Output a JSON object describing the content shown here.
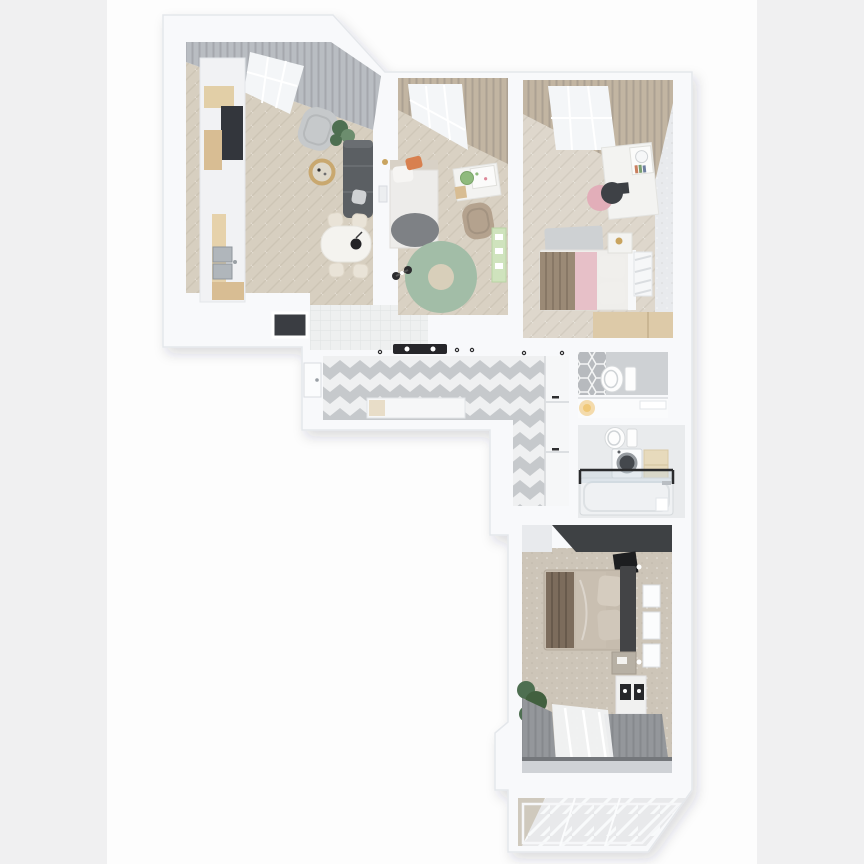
{
  "scene": {
    "type": "3d-floor-plan-render",
    "view": "top-down axonometric render of a two-bedroom-plus apartment",
    "background": "white canvas with light gray letterbox bars on left and right",
    "rooms": [
      {
        "id": "living-kitchen",
        "label": "kitchen-living-room",
        "features": [
          "kitchen run along left wall",
          "dark appliance column",
          "double steel sink",
          "gray armchair",
          "charcoal sofa",
          "round coffee table",
          "oval dining table with four cream chairs",
          "black pendant lamp",
          "gray curtains on angled window wall",
          "white tiled kitchen zone",
          "wall niche"
        ]
      },
      {
        "id": "bedroom-1",
        "label": "kids-bedroom",
        "features": [
          "single bed with orange pillow and gray throw",
          "green round rug",
          "white desk with pinboard",
          "green chair",
          "tan armchair",
          "green play shelf",
          "toy tricycle",
          "tan curtains with skylight window"
        ]
      },
      {
        "id": "bedroom-2",
        "label": "bedroom-with-pink-accents",
        "features": [
          "double bed with brown and pink blankets",
          "white desk with hutch and round mirror",
          "pink chair with dark jacket",
          "gray rug",
          "nightstand with gold lamp",
          "louvered wardrobe",
          "wood built-in block",
          "tan curtains with skylight window"
        ]
      },
      {
        "id": "hallway",
        "label": "hallway",
        "features": [
          "gray and white chevron tile floor",
          "white console",
          "beige tray",
          "built-in closets with black handles",
          "entry door",
          "black linear ceiling light",
          "spotlights"
        ]
      },
      {
        "id": "wc",
        "label": "wc",
        "features": [
          "toilet",
          "gray hex accent tiles"
        ]
      },
      {
        "id": "niche",
        "label": "hall-niche",
        "features": [
          "white shelf",
          "warm table lamp"
        ]
      },
      {
        "id": "bathroom",
        "label": "bathroom",
        "features": [
          "toilet",
          "washing machine with round door",
          "beige cabinet",
          "bathtub with black-trimmed glass screen"
        ]
      },
      {
        "id": "bedroom-3",
        "label": "master-bedroom",
        "features": [
          "dark wardrobe wall",
          "wall TV",
          "double bed with brown pleated throw",
          "white wall moldings",
          "sconces",
          "dark-top nightstand",
          "white dresser with dark trays",
          "plant",
          "gray drapes with white sheer",
          "window wall"
        ]
      },
      {
        "id": "balcony",
        "label": "glazed-balcony",
        "features": [
          "diagonal plank floor",
          "angled outer corner",
          "glazing frames"
        ]
      }
    ]
  },
  "colors": {
    "pagebg": "#fdfdfd",
    "sidebar": "#f0f0f1",
    "wall": "#f8f9fb",
    "wall_stroke": "#e4e7eb",
    "wall_face": "#e8eaed",
    "floor_living": "#d7cfc0",
    "floor_bed1": "#d9d1c3",
    "floor_bed2": "#ded7cc",
    "floor_bed3": "#cdc5b8",
    "tile_white": "#eef0f0",
    "hall_white": "#eff0f1",
    "hall_gray": "#c6c9cc",
    "wc_floor": "#ced1d4",
    "hex_gray": "#b7babe",
    "bath_floor": "#e9ebed",
    "curtain_gray": "#b9bdc2",
    "curtain_tan": "#c2b5a2",
    "curtain_dark": "#94979b",
    "sheer": "#f3f4f5",
    "window_glass": "#f4f6f8",
    "sofa_dark": "#5b5f63",
    "chair_gray": "#c6c9cb",
    "armchair_tan": "#b4a28e",
    "wood": "#d8bd93",
    "wood_light": "#e2cfa7",
    "steel": "#b0b6bb",
    "appliance_dark": "#33363c",
    "table_white": "#f4f3ef",
    "chair_cream": "#e9e3d7",
    "pendant_black": "#232326",
    "rug_green": "#a2bda7",
    "rug_center": "#d8cfba",
    "plant_green": "#4e6f51",
    "bed_white": "#edecea",
    "headboard_b1": "#d8d1c6",
    "pillow_orange": "#d8804f",
    "blanket_gray": "#7e8185",
    "play_green": "#cfe3bd",
    "chair_green": "#8fba7d",
    "desk_white": "#f3f3f1",
    "chair_pink": "#e2aeb9",
    "jacket_dark": "#3e4146",
    "rug_gray": "#ced1d3",
    "bed_brown": "#9b8a76",
    "bed_pink": "#e7c0c8",
    "mattress": "#efeeeb",
    "wood_block": "#ddcaa8",
    "dark_wall": "#3e4144",
    "tv_black": "#1d1e20",
    "bed3_beige": "#c6bcae",
    "throw_brown": "#7c6c5c",
    "headboard_dark": "#434446",
    "dresser_white": "#f1f1f0",
    "glass_blue": "#c3d2dc",
    "trim_black": "#2a2b2d",
    "balcony_floor": "#e8e9eb",
    "balcony_wedge": "#cfc9bd",
    "console_white": "#f6f7f8",
    "closet_white": "#f6f7f8",
    "toilet_white": "#fdfdfd",
    "washer_white": "#fafbfc",
    "cabinet_beige": "#e7dabc",
    "gold": "#c9a45f",
    "lamp_warm": "#f2d59e",
    "niche_dark": "#3a3d42",
    "window_wall_gray": "#cfd2d6",
    "rod_gray": "#74777b",
    "seam_gray": "#dcdfe2"
  }
}
